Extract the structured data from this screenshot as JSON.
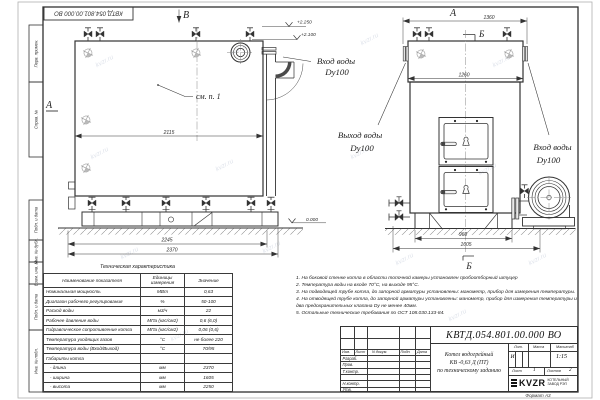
{
  "meta": {
    "watermark": "kvzr.ru",
    "format_label": "Формат  А3",
    "doc_number_top": "КВТД.054.801.00.000  ВО"
  },
  "frame_stamps": {
    "s1": "Перв. примен.",
    "s2": "Справ. №",
    "s3": "Подп. и дата",
    "s4": "Инв. № дубл.",
    "s5": "Взам. инв. №",
    "s6": "Подп. и дата",
    "s7": "Инв. № подл."
  },
  "drawing": {
    "view_a_label": "А",
    "view_b_label": "В",
    "view_a2_label": "А",
    "section_b_top": "Б",
    "section_b_bottom": "Б",
    "callout_see_p1": "см. п. 1",
    "dims": {
      "d2115": "2115",
      "d2245": "2245",
      "d2370": "2370",
      "d1360": "1360",
      "d1260": "1260",
      "d960": "960",
      "d1605": "1605"
    },
    "elevations": {
      "top": "+2.250",
      "mid": "+2.100",
      "zero": "0.000"
    },
    "labels": {
      "inlet_left": "Вход воды",
      "inlet_left_dn": "Dy100",
      "outlet": "Выход воды",
      "outlet_dn": "Dy100",
      "inlet_right": "Вход воды",
      "inlet_right_dn": "Dy100"
    }
  },
  "tech_table": {
    "title": "Техническая характеристика",
    "headers": [
      "Наименование показателя",
      "Единицы измерения",
      "Значение"
    ],
    "rows": [
      [
        "Номинальная мощность",
        "МВт",
        "0,63"
      ],
      [
        "Диапазон рабочего регулирования",
        "%",
        "50-100"
      ],
      [
        "Расход воды",
        "м3/ч",
        "22"
      ],
      [
        "Рабочее давление воды",
        "МПа (кгс/см2)",
        "0,6 (6,0)"
      ],
      [
        "Гидравлическое сопротивление котла",
        "МПа (кгс/см2)",
        "0,06 (0,6)"
      ],
      [
        "Температура уходящих газов",
        "°С",
        "не более 220"
      ],
      [
        "Температура воды (Вход/Выход)",
        "°С",
        "70/95"
      ],
      [
        "Габариты котла",
        "",
        ""
      ],
      [
        "   - длина",
        "мм",
        "2370"
      ],
      [
        "   - ширина",
        "мм",
        "1605"
      ],
      [
        "   - высота",
        "мм",
        "2250"
      ]
    ]
  },
  "notes": {
    "lines": [
      "1.  На боковой стенке котла в области топочной камеры установлен пробоотборный штуцер",
      "2.  Температура воды на входе 70°С, на выходе 95°С.",
      "3.  На подводящей трубе котла, до запорной арматуры установлены: манометр, прибор для измерения температуры.",
      "4.  На отводящей трубе котла, до запорной арматуры установлены: манометр, прибор для измерения температуры и два предохранительных клапана Dу не менее 40мм.",
      "5.  Остальные технические требования по ОСТ  108.030.133-84."
    ]
  },
  "title_block": {
    "doc_number": "КВТД.054.801.00.000  ВО",
    "rev_cols": [
      "Изм.",
      "Лист",
      "N докум.",
      "Подп.",
      "Дата"
    ],
    "roles": [
      "Разраб.",
      "Пров.",
      "Т.контр.",
      "Н.контр.",
      "Утв."
    ],
    "product_line1": "Котел водогрейный",
    "product_line2": "КВ -0,63  Д  (ПТ)",
    "product_line3": "по техническому заданию",
    "lit_label": "Лит.",
    "mass_label": "Масса",
    "scale_label": "Масштаб",
    "lit_value": "И",
    "scale_value": "1:15",
    "sheet_label": "Лист",
    "sheet_value": "1",
    "sheets_label": "Листов",
    "sheets_value": "2",
    "logo_text": "KVZR",
    "company_line1": "КОТЕЛЬНЫЙ",
    "company_line2": "ЗАВОД РЭП"
  }
}
